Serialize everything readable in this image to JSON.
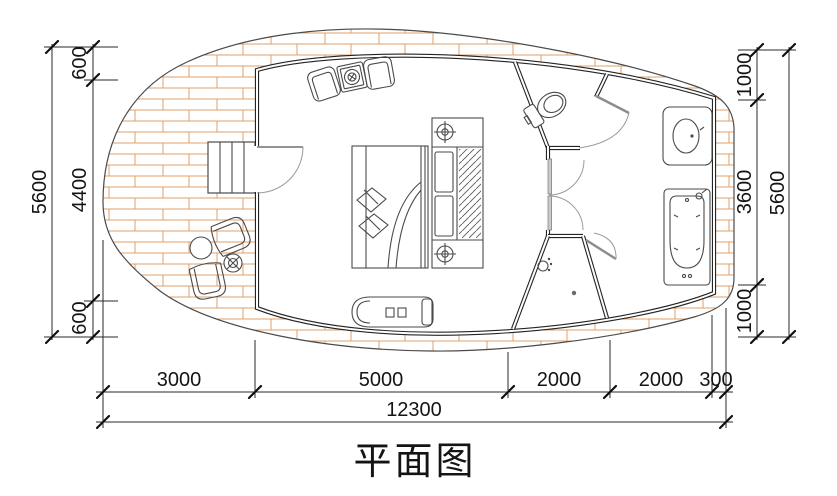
{
  "drawing": {
    "title": "平面图",
    "dimensions": {
      "left": {
        "outer": "5600",
        "chain": [
          "600",
          "4400",
          "600"
        ]
      },
      "right": {
        "outer": "5600",
        "chain": [
          "1000",
          "3600",
          "1000"
        ]
      },
      "bottom": {
        "chain": [
          "3000",
          "5000",
          "2000",
          "2000",
          "300"
        ],
        "total": "12300"
      }
    },
    "colors": {
      "deck_plank": "#dfa06a",
      "wall": "#242424",
      "dimension": "#141414",
      "door_swing": "#9a9a9a"
    }
  }
}
